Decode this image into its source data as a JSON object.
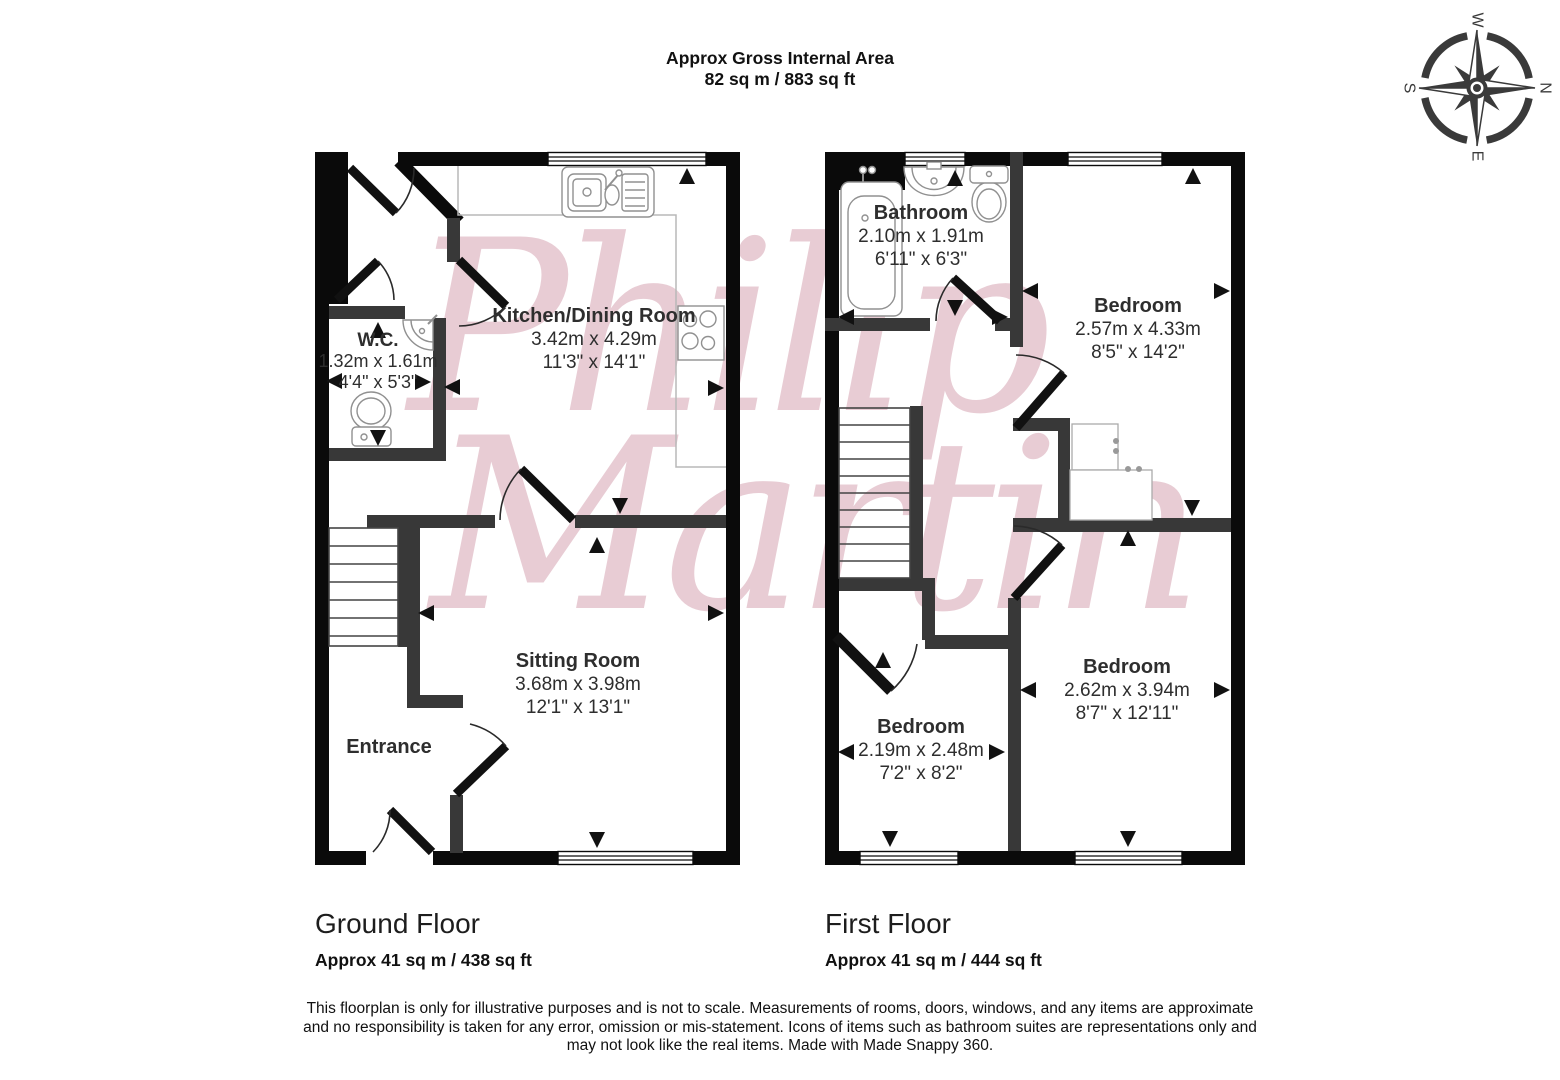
{
  "title": {
    "line1": "Approx Gross Internal Area",
    "line2": "82 sq m / 883 sq ft"
  },
  "compass": {
    "north": "N",
    "east": "E",
    "south": "S",
    "west": "W"
  },
  "watermark": {
    "line1": "Philip",
    "line2": "Martin"
  },
  "floors": {
    "ground": {
      "name": "Ground Floor",
      "area": "Approx 41 sq m / 438 sq ft",
      "rooms": {
        "wc": {
          "name": "W.C.",
          "metric": "1.32m x 1.61m",
          "imperial": "4'4\" x 5'3\""
        },
        "kitchen": {
          "name": "Kitchen/Dining Room",
          "metric": "3.42m x 4.29m",
          "imperial": "11'3\" x 14'1\""
        },
        "sitting": {
          "name": "Sitting Room",
          "metric": "3.68m x 3.98m",
          "imperial": "12'1\" x 13'1\""
        },
        "entrance": {
          "name": "Entrance"
        }
      }
    },
    "first": {
      "name": "First Floor",
      "area": "Approx 41 sq m / 444 sq ft",
      "rooms": {
        "bathroom": {
          "name": "Bathroom",
          "metric": "2.10m x 1.91m",
          "imperial": "6'11\" x 6'3\""
        },
        "bedroom1": {
          "name": "Bedroom",
          "metric": "2.57m x 4.33m",
          "imperial": "8'5\" x 14'2\""
        },
        "bedroom2": {
          "name": "Bedroom",
          "metric": "2.19m x 2.48m",
          "imperial": "7'2\" x 8'2\""
        },
        "bedroom3": {
          "name": "Bedroom",
          "metric": "2.62m x 3.94m",
          "imperial": "8'7\" x 12'11\""
        }
      }
    }
  },
  "disclaimer": {
    "line1": "This floorplan is only for illustrative purposes and is not to scale. Measurements of rooms, doors, windows, and any items are approximate",
    "line2": "and no responsibility is taken for any error, omission or mis-statement. Icons of items such as bathroom suites are representations only and",
    "line3": "may not look like the real items. Made with Made Snappy 360."
  },
  "colors": {
    "outer_wall": "#0a0a0a",
    "inner_wall": "#383838",
    "watermark_pink": "#c9879a",
    "fixture_stroke": "#909090",
    "counter_gray": "#b8b8b8"
  }
}
